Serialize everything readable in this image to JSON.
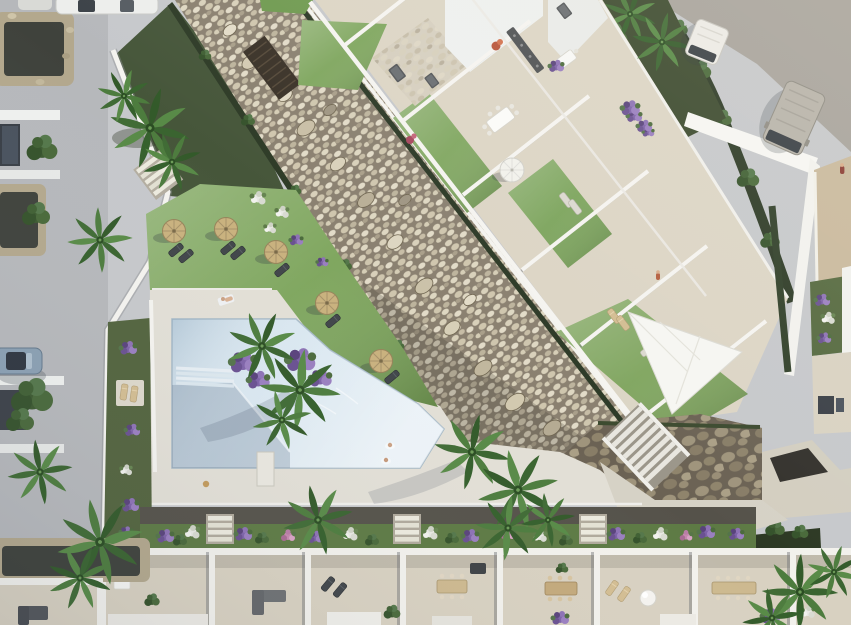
{
  "scene": {
    "type": "aerial-architectural-render",
    "description": "Top-down 3D visualization of a residential development: white apartment block with roof terraces and lawns set along a diagonal pebble garden band, communal lawn with straw parasols, an angular swimming pool with sun deck, side street with parked cars, service road with two vans, and a row of walled townhouse patios along the bottom.",
    "labels": {
      "street": "Side street with parked cars",
      "road": "Service road with vans",
      "band": "Diagonal pebble dry-garden band",
      "complex": "Apartment roof terraces with lawns",
      "lawn": "Communal lawn with straw parasols",
      "pool": "Angular swimming pool",
      "deck": "Pool sun deck",
      "stonewall": "Stone retaining wall and stairs",
      "terraces": "Townhouse patio row",
      "vegetation": "Palms, hedges and bougainvillea",
      "vehicles": "Parked vehicles",
      "people": "Residents"
    },
    "counts": {
      "straw_parasols": 6,
      "white_parasols": 2,
      "vans": 2,
      "cars": 2,
      "swimmers": 2,
      "sunbathers": 1
    }
  },
  "palette": {
    "pavement": "#c6c8cb",
    "road": "#a7a39d",
    "deck": "#e2dfd6",
    "travertine": "#dcd5c5",
    "pool": "#d6e5ef",
    "pool_shadow": "#9db6c6",
    "lawn": "#79a257",
    "lawn_dark": "#587d42",
    "gravel_soil": "#8a8070",
    "pebble_light": "#d7cfb9",
    "hedge": "#2e3b27",
    "wall_white": "#f2f1ec",
    "stone_wall": "#6b6254",
    "path_dark": "#55524a",
    "flowerbed": "#5d7a44",
    "terrace_floor": "#d8d1c1",
    "parasol_straw": "#c8ae7c",
    "parasol_white": "#f1f0ea",
    "flower_purple": "#7e63a8",
    "flower_white": "#e9e9e4",
    "palm_green": "#43703a",
    "van_gray": "#b7b3aa",
    "van_white": "#ecebe7",
    "car_blue": "#8ba0b3",
    "coral_red": "#b94b60"
  }
}
